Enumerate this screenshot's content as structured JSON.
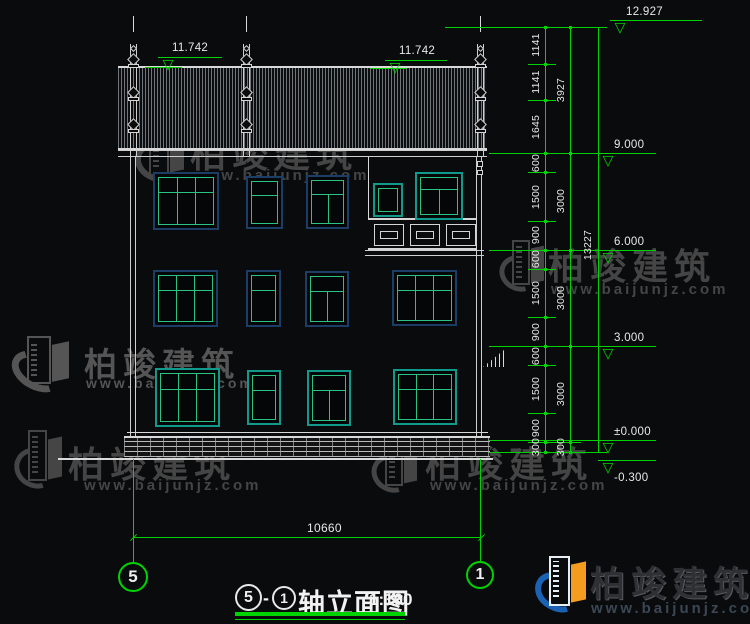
{
  "colors": {
    "green": "#00d400",
    "line_white": "#d9d9d9",
    "navy": "#1c3e66",
    "teal": "#0f9a8c",
    "grid": "#2bc284",
    "watermark_gray": "#474747",
    "logo_blue": "#1b62b5",
    "logo_orange": "#f49c1f"
  },
  "watermark_text": {
    "name": "柏竣建筑",
    "url": "www.baijunjz.com"
  },
  "watermarks": [
    {
      "ix": 138,
      "iy": 126,
      "iw": 48,
      "ih": 62,
      "tx": 190,
      "ty": 126,
      "ts": 36,
      "ux": 192,
      "uy": 167,
      "us": 15,
      "color": "#454545"
    },
    {
      "ix": 503,
      "iy": 240,
      "iw": 42,
      "ih": 56,
      "tx": 548,
      "ty": 238,
      "ts": 36,
      "ux": 551,
      "uy": 281,
      "us": 15,
      "color": "#454545"
    },
    {
      "ix": 14,
      "iy": 336,
      "iw": 58,
      "ih": 60,
      "tx": 84,
      "ty": 338,
      "ts": 33,
      "ux": 86,
      "uy": 375,
      "us": 14,
      "color": "#555555"
    },
    {
      "ix": 18,
      "iy": 430,
      "iw": 46,
      "ih": 64,
      "tx": 68,
      "ty": 436,
      "ts": 36,
      "ux": 84,
      "uy": 477,
      "us": 15,
      "color": "#454545"
    },
    {
      "ix": 375,
      "iy": 438,
      "iw": 44,
      "ih": 60,
      "tx": 425,
      "ty": 436,
      "ts": 36,
      "ux": 430,
      "uy": 477,
      "us": 15,
      "color": "#454545"
    }
  ],
  "logo": {
    "ix": 538,
    "iy": 556,
    "iw": 50,
    "ih": 62,
    "tx": 590,
    "ty": 556,
    "ts": 35,
    "ux": 591,
    "uy": 600,
    "us": 15,
    "text_color": "#2e3034",
    "url_color": "#3b4754"
  },
  "drawing": {
    "title": {
      "axis_start": "5",
      "separator": "-",
      "axis_end": "1",
      "name": "轴立面图",
      "scale": "1:100"
    },
    "eave_markers": [
      {
        "label": "11.742",
        "x1": 158,
        "x2": 222,
        "y": 57,
        "sub_x1": 145,
        "sub_x2": 182,
        "sub_y": 67
      },
      {
        "label": "11.742",
        "x1": 385,
        "x2": 447,
        "y": 60,
        "sub_x1": 370,
        "sub_x2": 407,
        "sub_y": 68
      }
    ],
    "levels": [
      {
        "label": "12.927",
        "y": 20,
        "x1": 610,
        "x2": 702,
        "below": false
      },
      {
        "label": "9.000",
        "y": 153,
        "x1": 598,
        "x2": 656,
        "below": false
      },
      {
        "label": "6.000",
        "y": 250,
        "x1": 598,
        "x2": 656,
        "below": false
      },
      {
        "label": "3.000",
        "y": 346,
        "x1": 598,
        "x2": 656,
        "below": false
      },
      {
        "label": "±0.000",
        "y": 440,
        "x1": 598,
        "x2": 656,
        "below": false
      },
      {
        "label": "-0.300",
        "y": 460,
        "x1": 598,
        "x2": 656,
        "below": true
      }
    ],
    "dim_chain": {
      "top_y": 27,
      "bottom_y": 452,
      "px_per_mm": 0.032131,
      "col1": {
        "x": 545,
        "segments": [
          1141,
          1141,
          1645,
          600,
          1500,
          900,
          600,
          1500,
          900,
          600,
          1500,
          900,
          300
        ]
      },
      "col2": {
        "x": 570,
        "segments": [
          3927,
          3000,
          3000,
          3000,
          300
        ]
      },
      "col3": {
        "x": 598,
        "label": "13227"
      },
      "top_line_x1": 445,
      "ext_lines_y": [
        153,
        250,
        346,
        440,
        452
      ],
      "ext_x1": 489
    },
    "width_dim": {
      "label": "10660",
      "x1": 133,
      "x2": 481,
      "y": 537,
      "label_x": 307,
      "label_y": 521
    },
    "axis_bubbles": [
      {
        "label": "5",
        "cx": 133,
        "cy": 577,
        "r": 15,
        "line_top": 459
      },
      {
        "label": "1",
        "cx": 480,
        "cy": 575,
        "r": 14,
        "line_top": 459
      }
    ],
    "windows": [
      {
        "x": 153,
        "y": 172,
        "w": 66,
        "h": 58,
        "type": "t3",
        "frame": "navy"
      },
      {
        "x": 246,
        "y": 176,
        "w": 37,
        "h": 53,
        "type": "t1",
        "frame": "navy"
      },
      {
        "x": 306,
        "y": 175,
        "w": 43,
        "h": 54,
        "type": "t2",
        "frame": "navy"
      },
      {
        "x": 153,
        "y": 270,
        "w": 65,
        "h": 57,
        "type": "t3",
        "frame": "navy"
      },
      {
        "x": 246,
        "y": 270,
        "w": 35,
        "h": 57,
        "type": "t1",
        "frame": "navy"
      },
      {
        "x": 305,
        "y": 271,
        "w": 44,
        "h": 56,
        "type": "t2",
        "frame": "navy"
      },
      {
        "x": 392,
        "y": 270,
        "w": 65,
        "h": 56,
        "type": "t3",
        "frame": "navy"
      },
      {
        "x": 155,
        "y": 368,
        "w": 65,
        "h": 59,
        "type": "t3",
        "frame": "teal"
      },
      {
        "x": 247,
        "y": 370,
        "w": 34,
        "h": 55,
        "type": "t1",
        "frame": "teal"
      },
      {
        "x": 307,
        "y": 370,
        "w": 44,
        "h": 56,
        "type": "t2",
        "frame": "teal"
      },
      {
        "x": 393,
        "y": 369,
        "w": 64,
        "h": 56,
        "type": "t3",
        "frame": "teal"
      },
      {
        "x": 373,
        "y": 183,
        "w": 30,
        "h": 34,
        "type": "s1",
        "frame": "teal"
      },
      {
        "x": 415,
        "y": 172,
        "w": 48,
        "h": 48,
        "type": "t2",
        "frame": "teal"
      }
    ],
    "finials": [
      {
        "cx": 133
      },
      {
        "cx": 246
      },
      {
        "cx": 480
      }
    ],
    "railing": {
      "x": 368,
      "y": 218,
      "w": 109,
      "h": 32,
      "panels": [
        6,
        42,
        78
      ],
      "pw": 30,
      "ph": 22
    }
  }
}
